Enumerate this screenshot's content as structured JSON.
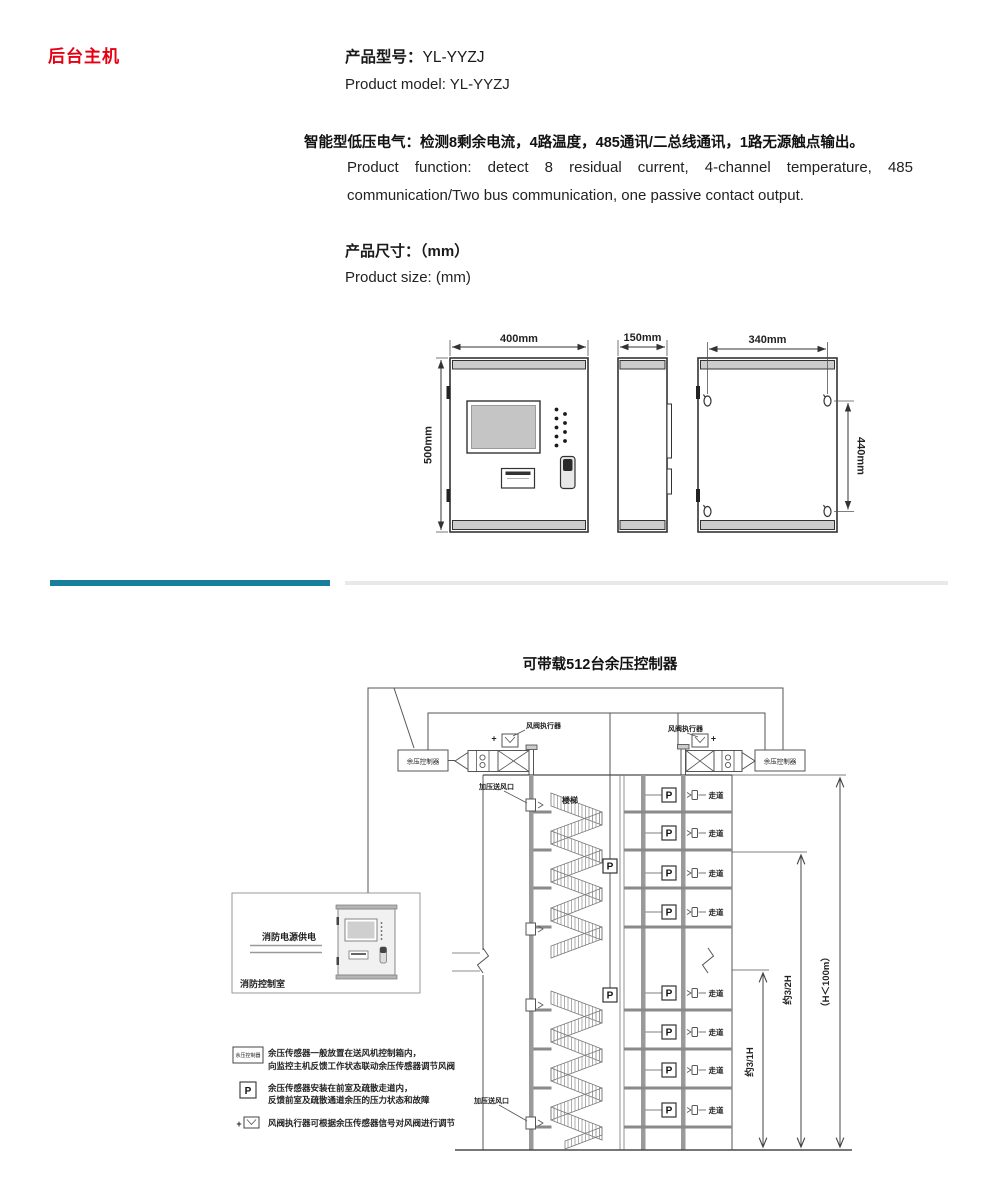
{
  "header": {
    "section_title": "后台主机",
    "model_label": "产品型号：",
    "model_value": "YL-YYZJ",
    "model_en": "Product model: YL-YYZJ",
    "function_zh": "智能型低压电气：检测8剩余电流，4路温度，485通讯/二总线通讯，1路无源触点输出。",
    "function_en1": "Product function: detect 8 residual current, 4-channel temperature, 485",
    "function_en2": "communication/Two bus communication, one passive contact output.",
    "size_zh": "产品尺寸：（mm）",
    "size_en": "Product size: (mm)"
  },
  "dims": {
    "front_width": "400mm",
    "front_height": "500mm",
    "depth": "150mm",
    "mount_width": "340mm",
    "mount_height": "440mm"
  },
  "diagram": {
    "title": "可带载512台余压控制器",
    "controller": "余压控制器",
    "actuator": "风阀执行器",
    "outlet": "加压送风口",
    "stairs": "楼梯",
    "corridor": "走道",
    "sensor": "P",
    "plus": "+",
    "dim_lower": "约3/1H",
    "dim_middle": "约3/2H",
    "dim_total": "（H＜100m）",
    "fire_power": "消防电源供电",
    "fire_room": "消防控制室",
    "legend": [
      {
        "line1": "余压传感器一般放置在送风机控制箱内，",
        "line2": "向监控主机反馈工作状态联动余压传感器调节风阀"
      },
      {
        "line1": "余压传感器安装在前室及疏散走道内，",
        "line2": "反馈前室及疏散通道余压的压力状态和故障"
      },
      {
        "line1": "风阀执行器可根据余压传感器信号对风阀进行调节",
        "line2": ""
      }
    ]
  },
  "colors": {
    "accent_red": "#e60012",
    "divider_teal": "#177f99",
    "divider_gray": "#e9e9e9"
  }
}
